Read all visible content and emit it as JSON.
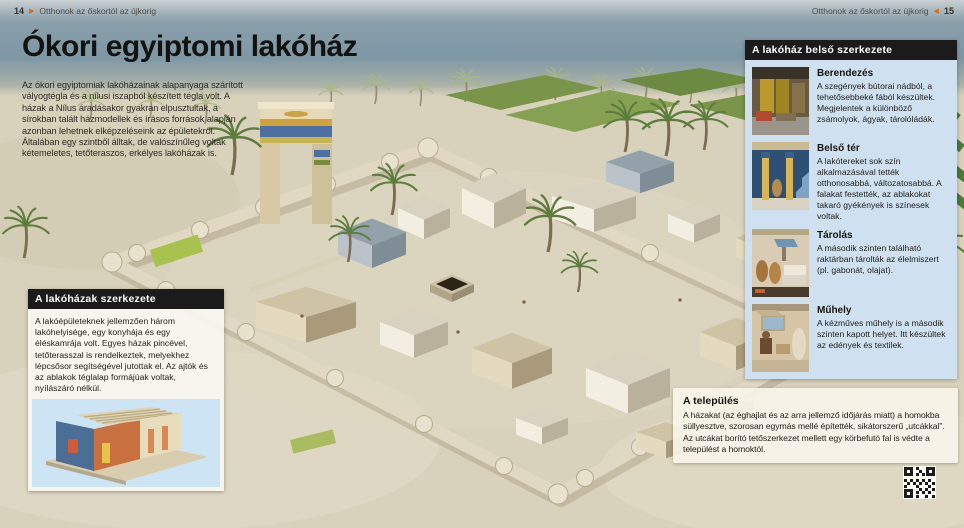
{
  "icons": {
    "forward": "▶",
    "back": "◀"
  },
  "header_left": {
    "page_number": "14",
    "title": "Otthonok az őskortól az újkorig"
  },
  "header_right": {
    "page_number": "15",
    "title": "Otthonok az őskortól az újkorig"
  },
  "main": {
    "title": "Ókori egyiptomi lakóház",
    "intro": "Az ókori egyiptomiak lakóházainak alapanyaga szárított vályogtégla és a nílusi iszapból készített tégla volt. A házak a Nílus áradásakor gyakran elpusztultak, a sírokban talált házmodellek és írásos források alapján azonban lehetnek elképzeléseink az épületekről. Általában egy szintből álltak, de valószínűleg voltak kétemeletes, tetőteraszos, erkélyes lakóházak is."
  },
  "left_box": {
    "header": "A lakóházak szerkezete",
    "body": "A lakóépületeknek jellemzően három lakóhelyisége, egy konyhája és egy éléskamrája volt. Egyes házak pincével, tetőterasszal is rendelkeztek, melyekhez lépcsősor segítségével jutottak el. Az ajtók és az ablakok téglalap formájúak voltak, nyílászáró nélkül."
  },
  "sidebar": {
    "header": "A lakóház belső szerkezete",
    "sections": [
      {
        "title": "Berendezés",
        "text": "A szegények bútorai nádból, a tehetősebbeké fából készültek. Megjelentek a különböző zsámolyok, ágyak, tárolóládák."
      },
      {
        "title": "Belső tér",
        "text": "A lakótereket sok szín alkalmazásával tették otthonosabbá, változatosabbá. A falakat festették, az ablakokat takaró gyékények is színesek voltak."
      },
      {
        "title": "Tárolás",
        "text": "A második szinten található raktárban tárolták az élelmiszert (pl. gabonát, olajat)."
      },
      {
        "title": "Műhely",
        "text": "A kézműves műhely is a második szinten kapott helyet. Itt készültek az edények és textilek."
      }
    ]
  },
  "settlement_box": {
    "header": "A település",
    "body": "A házakat (az éghajlat és az arra jellemző időjárás miatt) a homokba süllyesztve, szorosan egymás mellé építették, sikátorszerű „utcákkal”. Az utcákat borító tetőszerkezet mellett egy körbefutó fal is védte a települést a homoktól."
  },
  "colors": {
    "accent_orange": "#d96d1a",
    "header_bar_black": "#1b1b1b",
    "sidebar_blue": "#cfe1f0",
    "sand": "#d8d1bb",
    "water_band": "#7e97a5",
    "field_green": "#7a9449",
    "wall_cream": "#e0d8c3",
    "gate_blue": "#4c70a2",
    "gate_gold": "#d2a23c"
  }
}
